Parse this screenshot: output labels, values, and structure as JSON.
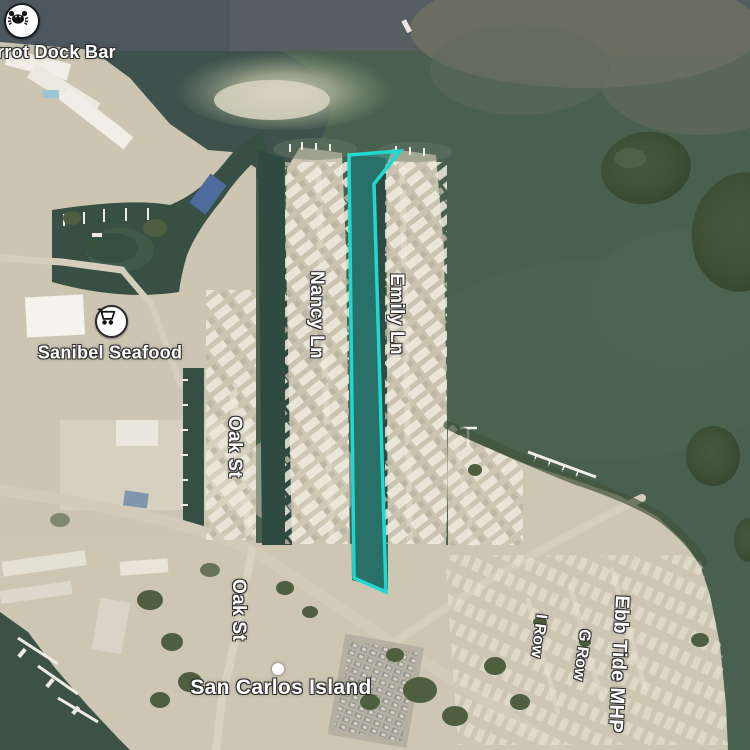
{
  "map": {
    "view_type": "satellite",
    "pois": [
      {
        "label": "rrot Dock Bar",
        "icon": "crab-icon"
      },
      {
        "label": "Sanibel Seafood",
        "icon": "shopping-cart-icon"
      }
    ],
    "streets": [
      {
        "label": "Nancy Ln"
      },
      {
        "label": "Emily Ln"
      },
      {
        "label": "Oak St"
      },
      {
        "label": "Oak St"
      },
      {
        "label": "I Row"
      },
      {
        "label": "G Row"
      },
      {
        "label": "Ebb Tide MHP"
      }
    ],
    "places": [
      {
        "label": "San Carlos Island"
      }
    ],
    "highlight": {
      "shape": "selected-canal-parcel-outline",
      "stroke_color": "#1fd9d1",
      "fill_color": "rgba(31,217,209,0.27)"
    },
    "colors": {
      "water": "#48604d",
      "water_dark": "#3c4f4a",
      "water_north": "#565e61",
      "land": "#cbc5b2",
      "vegetation": "#4e5f3f"
    }
  }
}
